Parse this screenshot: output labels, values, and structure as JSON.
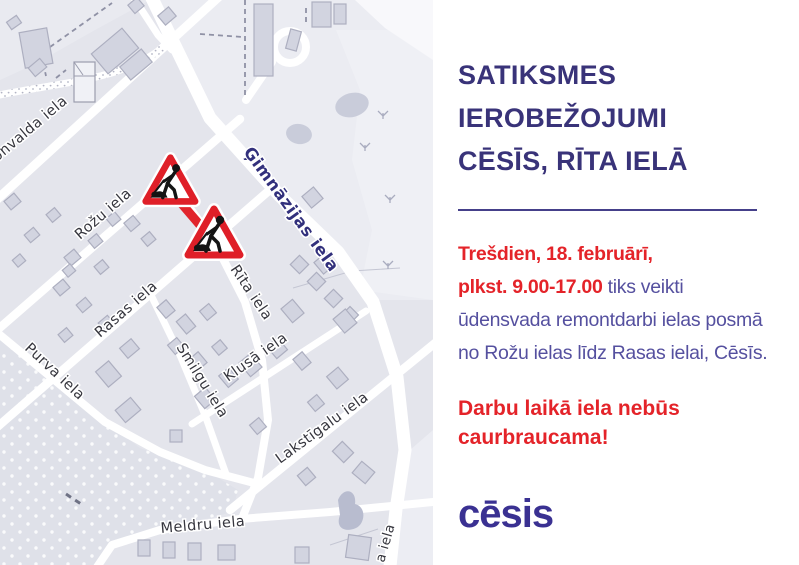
{
  "map": {
    "streets": {
      "kronvalda": "onvalda iela",
      "gimnazijas": "Ģimnāzijas iela",
      "rozu": "Rožu iela",
      "rasas": "Rasas iela",
      "rita": "Rīta iela",
      "purva": "Purva iela",
      "smilgu": "Smilgu iela",
      "klusa": "Klusā iela",
      "lakstigalu": "Lakstīgalu iela",
      "meldru": "Meldru iela",
      "partial_right": "a iela"
    },
    "warning_signs": [
      {
        "type": "roadworks-sign"
      },
      {
        "type": "roadworks-sign"
      }
    ],
    "closed_segment_color": "#e1242c"
  },
  "panel": {
    "title_lines": [
      "SATIKSMES",
      "IEROBEŽOJUMI",
      "CĒSĪS, RĪTA IELĀ"
    ],
    "body_lines": [
      {
        "red": "Trešdien, 18. februārī,",
        "normal": ""
      },
      {
        "red": "plkst. 9.00-17.00",
        "normal": " tiks veikti"
      },
      {
        "red": "",
        "normal": "ūdensvada remontdarbi ielas posmā"
      },
      {
        "red": "",
        "normal": "no Rožu ielas līdz Rasas ielai, Cēsīs."
      }
    ],
    "warning_lines": [
      "Darbu laikā iela nebūs",
      "caurbraucama!"
    ],
    "logo": "cēsis"
  },
  "colors": {
    "accent_blue": "#393379",
    "body_blue": "#55509f",
    "accent_red": "#e42329",
    "logo_blue": "#3a3192",
    "map_label_blue": "#32307c",
    "map_background": "#e4e5ec",
    "road": "#ffffff"
  }
}
